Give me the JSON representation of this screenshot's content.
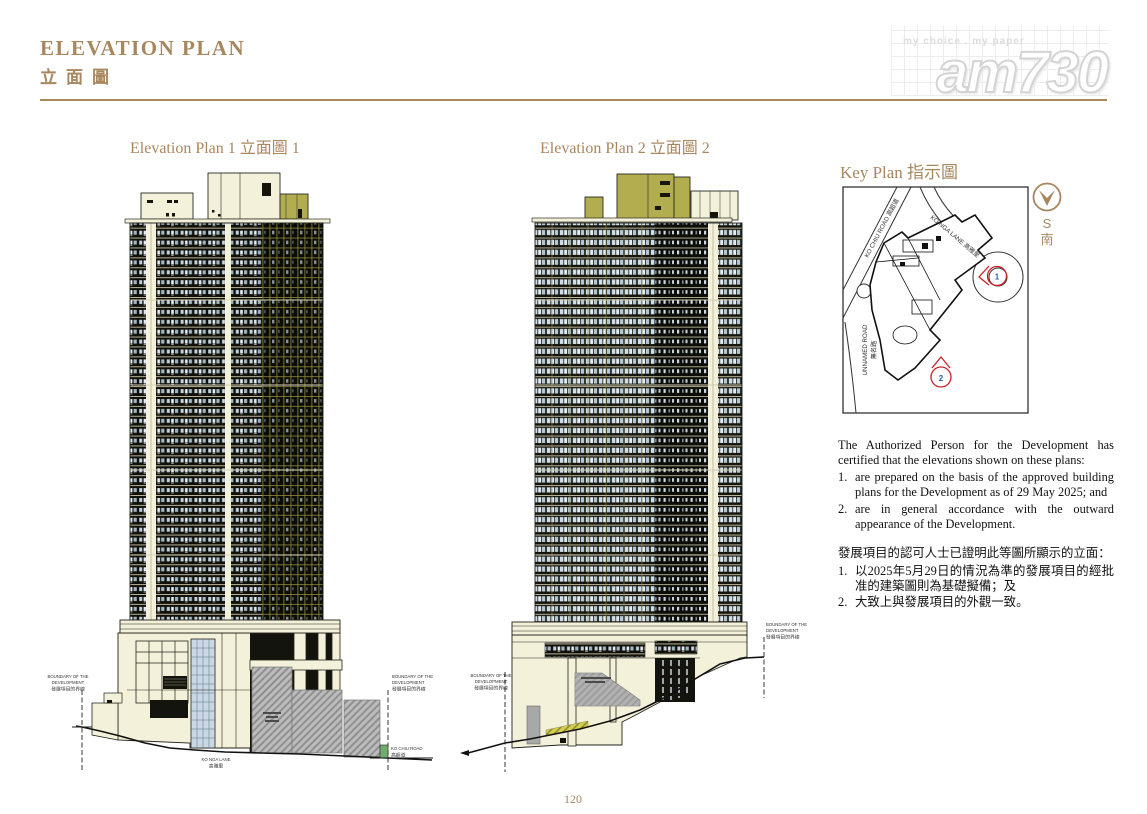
{
  "header": {
    "title_en": "ELEVATION PLAN",
    "title_zh": "立面圖"
  },
  "logo": {
    "tagline": "my choice . my paper",
    "brand": "am730"
  },
  "plans": {
    "plan1_title": "Elevation Plan 1 立面圖 1",
    "plan2_title": "Elevation Plan 2 立面圖 2"
  },
  "boundary": {
    "l1": "BOUNDARY OF THE",
    "l2": "DEVELOPMENT",
    "l3": "發展項目的界線"
  },
  "roads": {
    "ko_nga_en": "KO NGA LANE",
    "ko_nga_zh": "高雅里",
    "ko_chiu_en": "KO CHIU ROAD",
    "ko_chiu_zh": "高超道"
  },
  "key_plan": {
    "title": "Key Plan 指示圖",
    "compass_s": "S",
    "compass_nan": "南",
    "road_ko_chiu": "KO CHIU ROAD 高超道",
    "road_ko_nga": "KO NGA LANE 高雅里",
    "road_unnamed_en": "UNNAMED ROAD",
    "road_unnamed_zh": "無名路",
    "marker1": "1",
    "marker2": "2"
  },
  "certification": {
    "en_intro": "The Authorized Person for the Development has certified that the elevations shown on these plans:",
    "en_items": [
      {
        "num": "1.",
        "text": "are prepared on the basis of the approved building plans for the Development as of 29 May 2025; and"
      },
      {
        "num": "2.",
        "text": "are in general accordance with the outward appearance of the Development."
      }
    ],
    "zh_intro": "發展項目的認可人士已證明此等圖所顯示的立面：",
    "zh_items": [
      {
        "num": "1.",
        "text": "以2025年5月29日的情況為準的發展項目的經批准的建築圖則為基礎擬備；及"
      },
      {
        "num": "2.",
        "text": "大致上與發展項目的外觀一致。"
      }
    ]
  },
  "footer": {
    "page_number": "120"
  }
}
